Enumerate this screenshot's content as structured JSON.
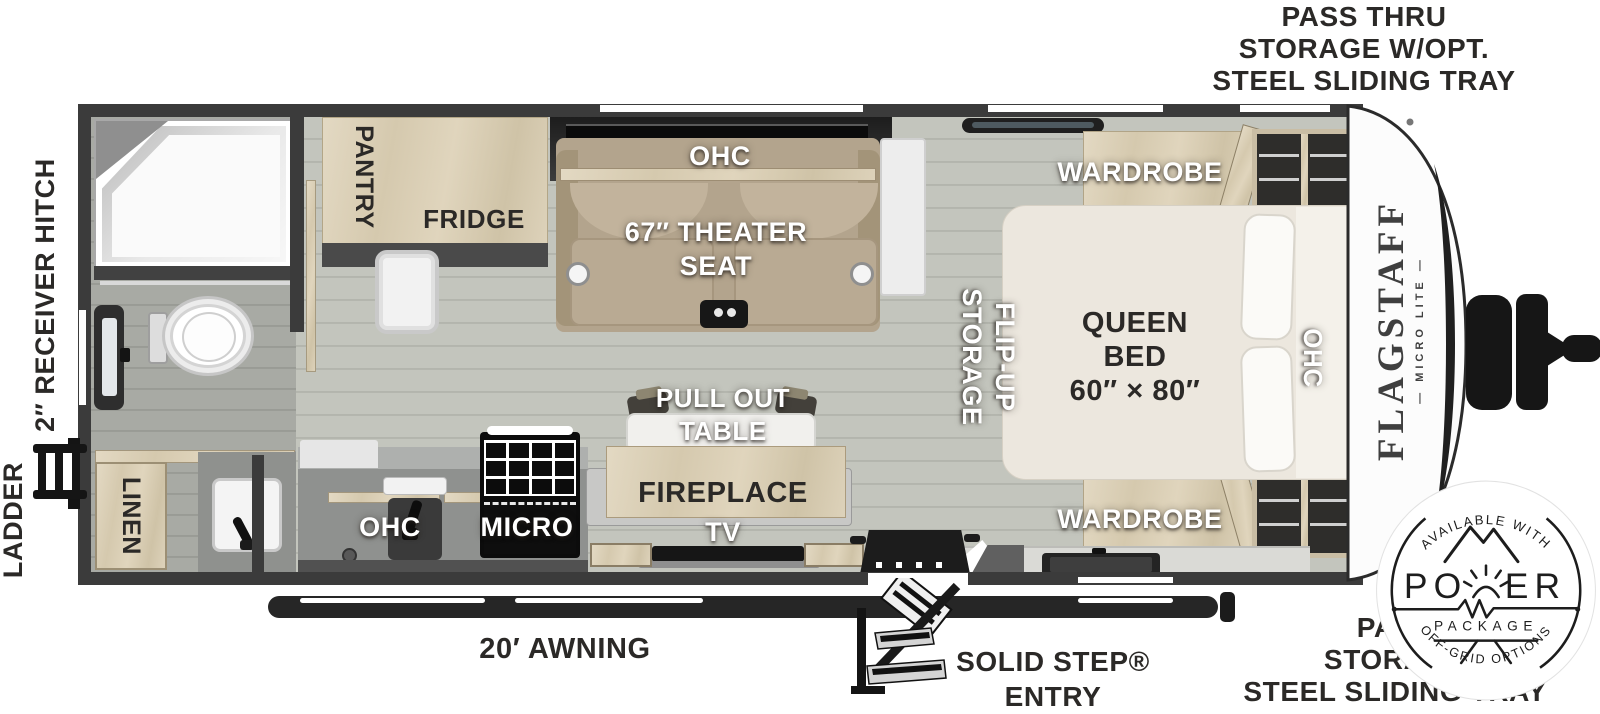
{
  "exterior": {
    "pass_thru_top": {
      "l1": "PASS THRU",
      "l2": "STORAGE W/OPT.",
      "l3": "STEEL SLIDING TRAY"
    },
    "receiver_hitch": "2″ RECEIVER HITCH",
    "ladder": "LADDER",
    "awning": "20′ AWNING",
    "solid_step": {
      "l1": "SOLID STEP®",
      "l2": "ENTRY"
    },
    "pass_thru_bottom": {
      "l1": "PASS",
      "l2": "STORAGE",
      "l3": "STEEL SLIDING TRAY"
    }
  },
  "interior": {
    "pantry": "PANTRY",
    "fridge": "FRIDGE",
    "sofa_ohc": "OHC",
    "theater": {
      "l1": "67″ THEATER",
      "l2": "SEAT"
    },
    "wardrobe_top": "WARDROBE",
    "wardrobe_bottom": "WARDROBE",
    "queen_bed": {
      "l1": "QUEEN",
      "l2": "BED",
      "l3": "60″ × 80″"
    },
    "flip_up": {
      "l1": "FLIP-UP",
      "l2": "STORAGE"
    },
    "bed_ohc": "OHC",
    "linen": "LINEN",
    "kitchen_ohc": "OHC",
    "micro": "MICRO",
    "pull_out_table": {
      "l1": "PULL OUT",
      "l2": "TABLE"
    },
    "fireplace": "FIREPLACE",
    "tv": "TV"
  },
  "brand": {
    "name": "FLAGSTAFF",
    "sub": "— MICRO LITE —"
  },
  "badge": {
    "top": "AVAILABLE WITH",
    "power_left": "PO",
    "power_right": "ER",
    "package": "PACKAGE",
    "bottom": "OFF-GRID OPTIONS"
  },
  "colors": {
    "wall": "#3b3b3b",
    "wood": "#d9cdb4",
    "floor": "#c1c3bb",
    "text_dark": "#2b2927",
    "seat_beige": "#b3a48d",
    "badge_ink": "#1d1d1d"
  }
}
